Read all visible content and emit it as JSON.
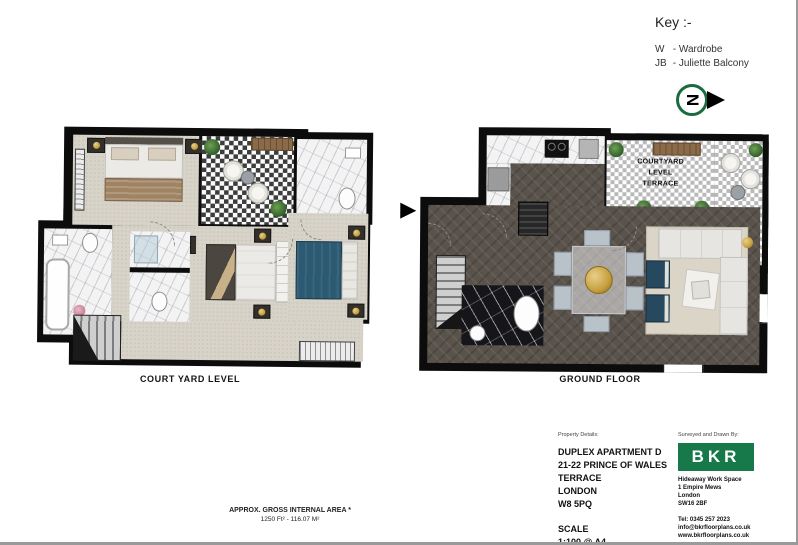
{
  "key": {
    "title": "Key :-",
    "items": [
      {
        "abbr": "W",
        "label": "-  Wardrobe"
      },
      {
        "abbr": "JB",
        "label": "- Juliette Balcony"
      }
    ],
    "north_letter": "N"
  },
  "plans": {
    "courtyard": {
      "label": "COURT YARD LEVEL"
    },
    "ground": {
      "label": "GROUND FLOOR",
      "terrace_lines": [
        "COURTYARD",
        "LEVEL",
        "TERRACE"
      ]
    }
  },
  "area_note": {
    "line1": "APPROX. GROSS INTERNAL AREA *",
    "line2": "1250 Ft²  -  116.07 M²"
  },
  "title_block": {
    "property_header": "Property Details:",
    "property_lines": [
      "DUPLEX APARTMENT D",
      "21-22 PRINCE OF WALES TERRACE",
      "LONDON",
      "W8 5PQ"
    ],
    "scale_label": "SCALE",
    "scale_value": "1:100 @ A4",
    "plans_drawn": "Plans Drawn: 22.01.2020",
    "surveyor_header": "Surveyed and Drawn By:",
    "logo_text": "BKR",
    "address_lines": [
      "Hideaway Work Space",
      "1 Empire Mews",
      "London",
      "SW16 2BF"
    ],
    "tel": "Tel: 0345 257 2023",
    "email": "info@bkrfloorplans.co.uk",
    "website": "www.bkrfloorplans.co.uk",
    "copyright": "© BKR2020"
  },
  "colors": {
    "brand_green": "#17784a",
    "north_green": "#1a6b3f",
    "wall_black": "#0c0c0c",
    "carpet_beige": "#d8d3c8",
    "wood_dark": "#5a534c",
    "bed_blue": "#2b5a72",
    "accent_gold": "#c6a03e"
  }
}
